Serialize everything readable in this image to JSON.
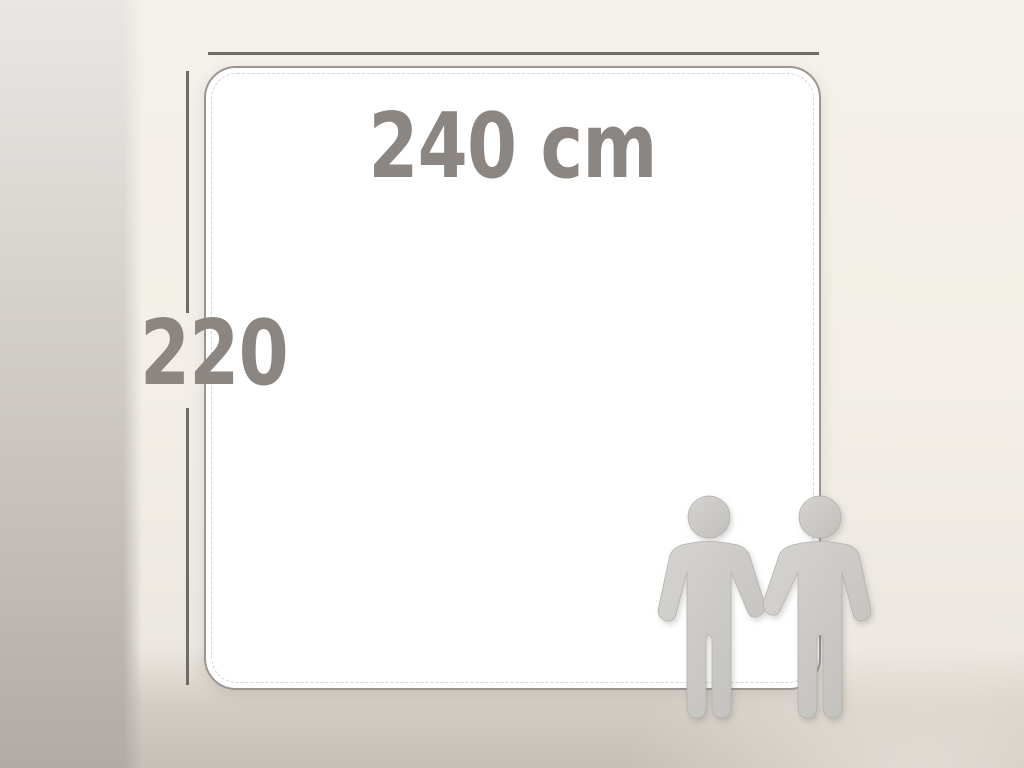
{
  "illustration": {
    "type": "product-dimension-diagram",
    "width_label": "240 cm",
    "height_label": "220"
  },
  "colors": {
    "label_text": "#8b8681",
    "dimension_line": "#6f6b66",
    "panel_fill": "#ffffff",
    "panel_border": "#9b958f",
    "stitch_line": "#d9d5d0",
    "figure_fill_light": "#d4d2ce",
    "figure_fill_dark": "#c1bfbb",
    "figure_outline": "#b4b2ae",
    "background_top": "#f4f1ea",
    "background_floor": "#d3ccc4",
    "background_left_shadow": "#b1aba7"
  },
  "icons": {
    "person_icon_count": 2
  }
}
